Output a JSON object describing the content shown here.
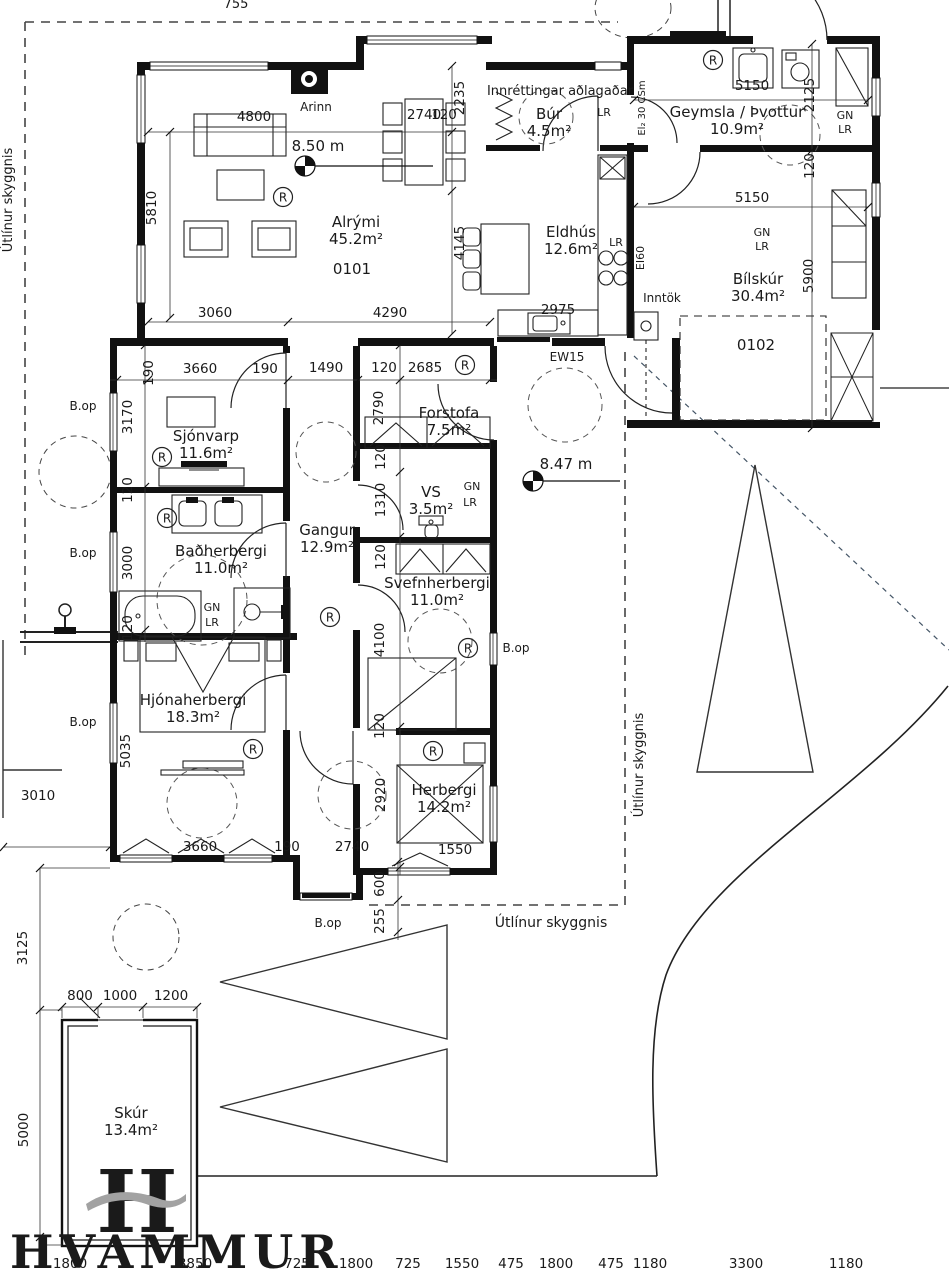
{
  "symbols": {
    "r": "R"
  },
  "logo": {
    "letter": "H",
    "text": "HVAMMUR",
    "green": "#1b5c38",
    "gray": "#a2a2a2"
  },
  "rooms": [
    {
      "name": "Alrými",
      "area": "45.2m²",
      "x": 356,
      "y": 227
    },
    {
      "name": "Eldhús",
      "area": "12.6m²",
      "x": 571,
      "y": 237
    },
    {
      "name": "Búr",
      "area": "4.5m²",
      "x": 549,
      "y": 119
    },
    {
      "name": "Geymsla / Þvottur",
      "area": "10.9m²",
      "x": 737,
      "y": 117
    },
    {
      "name": "Bílskúr",
      "area": "30.4m²",
      "x": 758,
      "y": 284
    },
    {
      "name": "Sjónvarp",
      "area": "11.6m²",
      "x": 206,
      "y": 441
    },
    {
      "name": "Forstofa",
      "area": "7.5m²",
      "x": 449,
      "y": 418
    },
    {
      "name": "VS",
      "area": "3.5m²",
      "x": 431,
      "y": 497
    },
    {
      "name": "Gangur",
      "area": "12.9m²",
      "x": 327,
      "y": 535
    },
    {
      "name": "Baðherbergi",
      "area": "11.0m²",
      "x": 221,
      "y": 556
    },
    {
      "name": "Svefnherbergi",
      "area": "11.0m²",
      "x": 437,
      "y": 588
    },
    {
      "name": "Hjónaherbergi",
      "area": "18.3m²",
      "x": 193,
      "y": 705
    },
    {
      "name": "Herbergi",
      "area": "14.2m²",
      "x": 444,
      "y": 795
    },
    {
      "name": "Skúr",
      "area": "13.4m²",
      "x": 131,
      "y": 1118
    }
  ],
  "labels": [
    {
      "t": "Útlínur skyggnis",
      "x": 12,
      "y": 200,
      "v": 1,
      "s": 13
    },
    {
      "t": "Útlínur skyggnis",
      "x": 643,
      "y": 765,
      "v": 1,
      "s": 13
    },
    {
      "t": "Útlínur skyggnis",
      "x": 551,
      "y": 927,
      "s": 14
    },
    {
      "t": "Innréttingar aðlagaðar",
      "x": 560,
      "y": 95,
      "s": 13
    },
    {
      "t": "Arinn",
      "x": 316,
      "y": 111,
      "s": 12
    },
    {
      "t": "8.50 m",
      "x": 318,
      "y": 151,
      "s": 15
    },
    {
      "t": "8.47 m",
      "x": 566,
      "y": 469,
      "s": 15
    },
    {
      "t": "0101",
      "x": 352,
      "y": 274,
      "s": 15
    },
    {
      "t": "0102",
      "x": 756,
      "y": 350,
      "s": 15
    },
    {
      "t": "B.op",
      "x": 83,
      "y": 410,
      "s": 12
    },
    {
      "t": "B.op",
      "x": 83,
      "y": 557,
      "s": 12
    },
    {
      "t": "B.op",
      "x": 83,
      "y": 726,
      "s": 12
    },
    {
      "t": "B.op",
      "x": 516,
      "y": 652,
      "s": 12
    },
    {
      "t": "B.op",
      "x": 328,
      "y": 927,
      "s": 12
    },
    {
      "t": "LR",
      "x": 604,
      "y": 116,
      "s": 11
    },
    {
      "t": "LR",
      "x": 616,
      "y": 246,
      "s": 11
    },
    {
      "t": "GN",
      "x": 845,
      "y": 119,
      "s": 11
    },
    {
      "t": "LR",
      "x": 845,
      "y": 133,
      "s": 11
    },
    {
      "t": "GN",
      "x": 762,
      "y": 236,
      "s": 11
    },
    {
      "t": "LR",
      "x": 762,
      "y": 250,
      "s": 11
    },
    {
      "t": "GN",
      "x": 472,
      "y": 490,
      "s": 11
    },
    {
      "t": "LR",
      "x": 470,
      "y": 506,
      "s": 11
    },
    {
      "t": "GN",
      "x": 212,
      "y": 611,
      "s": 11
    },
    {
      "t": "LR",
      "x": 212,
      "y": 626,
      "s": 11
    },
    {
      "t": "El₂ 30 CSm",
      "x": 645,
      "y": 108,
      "v": 1,
      "s": 10
    },
    {
      "t": "EI60",
      "x": 644,
      "y": 258,
      "v": 1,
      "s": 11
    },
    {
      "t": "Inntök",
      "x": 662,
      "y": 302,
      "s": 12
    },
    {
      "t": "EW15",
      "x": 567,
      "y": 361,
      "s": 12
    },
    {
      "t": "755",
      "x": 236,
      "y": 8,
      "s": 13
    }
  ],
  "dim_labels": [
    {
      "t": "4800",
      "x": 254,
      "y": 121
    },
    {
      "t": "2740",
      "x": 424,
      "y": 119
    },
    {
      "t": "2235",
      "x": 464,
      "y": 98,
      "v": 1
    },
    {
      "t": "4145",
      "x": 464,
      "y": 243,
      "v": 1
    },
    {
      "t": "120",
      "x": 444,
      "y": 119
    },
    {
      "t": "5150",
      "x": 752,
      "y": 90
    },
    {
      "t": "2125",
      "x": 814,
      "y": 95,
      "v": 1
    },
    {
      "t": "120",
      "x": 814,
      "y": 166,
      "v": 1
    },
    {
      "t": "5150",
      "x": 752,
      "y": 202
    },
    {
      "t": "5900",
      "x": 813,
      "y": 276,
      "v": 1
    },
    {
      "t": "5810",
      "x": 156,
      "y": 208,
      "v": 1
    },
    {
      "t": "3060",
      "x": 215,
      "y": 317
    },
    {
      "t": "4290",
      "x": 390,
      "y": 317
    },
    {
      "t": "2975",
      "x": 558,
      "y": 314
    },
    {
      "t": "190",
      "x": 153,
      "y": 373,
      "v": 1
    },
    {
      "t": "3660",
      "x": 200,
      "y": 373
    },
    {
      "t": "190",
      "x": 265,
      "y": 373
    },
    {
      "t": "1490",
      "x": 326,
      "y": 372
    },
    {
      "t": "120",
      "x": 384,
      "y": 372
    },
    {
      "t": "2685",
      "x": 425,
      "y": 372
    },
    {
      "t": "3170",
      "x": 132,
      "y": 417,
      "v": 1
    },
    {
      "t": "120",
      "x": 132,
      "y": 490,
      "v": 1
    },
    {
      "t": "3000",
      "x": 132,
      "y": 563,
      "v": 1
    },
    {
      "t": "120",
      "x": 132,
      "y": 628,
      "v": 1
    },
    {
      "t": "5035",
      "x": 130,
      "y": 751,
      "v": 1
    },
    {
      "t": "2790",
      "x": 383,
      "y": 408,
      "v": 1
    },
    {
      "t": "120",
      "x": 385,
      "y": 457,
      "v": 1
    },
    {
      "t": "1310",
      "x": 385,
      "y": 500,
      "v": 1
    },
    {
      "t": "120",
      "x": 385,
      "y": 557,
      "v": 1
    },
    {
      "t": "4100",
      "x": 384,
      "y": 640,
      "v": 1
    },
    {
      "t": "120",
      "x": 384,
      "y": 726,
      "v": 1
    },
    {
      "t": "2920",
      "x": 385,
      "y": 795,
      "v": 1
    },
    {
      "t": "3660",
      "x": 200,
      "y": 851
    },
    {
      "t": "190",
      "x": 287,
      "y": 851
    },
    {
      "t": "2740",
      "x": 352,
      "y": 851
    },
    {
      "t": "1550",
      "x": 455,
      "y": 854
    },
    {
      "t": "600",
      "x": 384,
      "y": 884,
      "v": 1
    },
    {
      "t": "255",
      "x": 384,
      "y": 921,
      "v": 1
    },
    {
      "t": "3010",
      "x": 38,
      "y": 800
    },
    {
      "t": "3125",
      "x": 27,
      "y": 948,
      "v": 1
    },
    {
      "t": "5000",
      "x": 28,
      "y": 1130,
      "v": 1
    },
    {
      "t": "800",
      "x": 80,
      "y": 1000
    },
    {
      "t": "1000",
      "x": 120,
      "y": 1000
    },
    {
      "t": "1200",
      "x": 171,
      "y": 1000
    },
    {
      "t": "1800",
      "x": 70,
      "y": 1268
    },
    {
      "t": "3850",
      "x": 195,
      "y": 1268
    },
    {
      "t": "725",
      "x": 297,
      "y": 1268
    },
    {
      "t": "1800",
      "x": 356,
      "y": 1268
    },
    {
      "t": "725",
      "x": 408,
      "y": 1268
    },
    {
      "t": "1550",
      "x": 462,
      "y": 1268
    },
    {
      "t": "475",
      "x": 511,
      "y": 1268
    },
    {
      "t": "1800",
      "x": 556,
      "y": 1268
    },
    {
      "t": "475",
      "x": 611,
      "y": 1268
    },
    {
      "t": "1180",
      "x": 650,
      "y": 1268
    },
    {
      "t": "3300",
      "x": 746,
      "y": 1268
    },
    {
      "t": "1180",
      "x": 846,
      "y": 1268
    }
  ],
  "r_symbols": [
    {
      "x": 283,
      "y": 197
    },
    {
      "x": 713,
      "y": 60
    },
    {
      "x": 162,
      "y": 457
    },
    {
      "x": 465,
      "y": 365
    },
    {
      "x": 167,
      "y": 518
    },
    {
      "x": 330,
      "y": 617
    },
    {
      "x": 253,
      "y": 749
    },
    {
      "x": 468,
      "y": 648
    },
    {
      "x": 433,
      "y": 751
    }
  ]
}
